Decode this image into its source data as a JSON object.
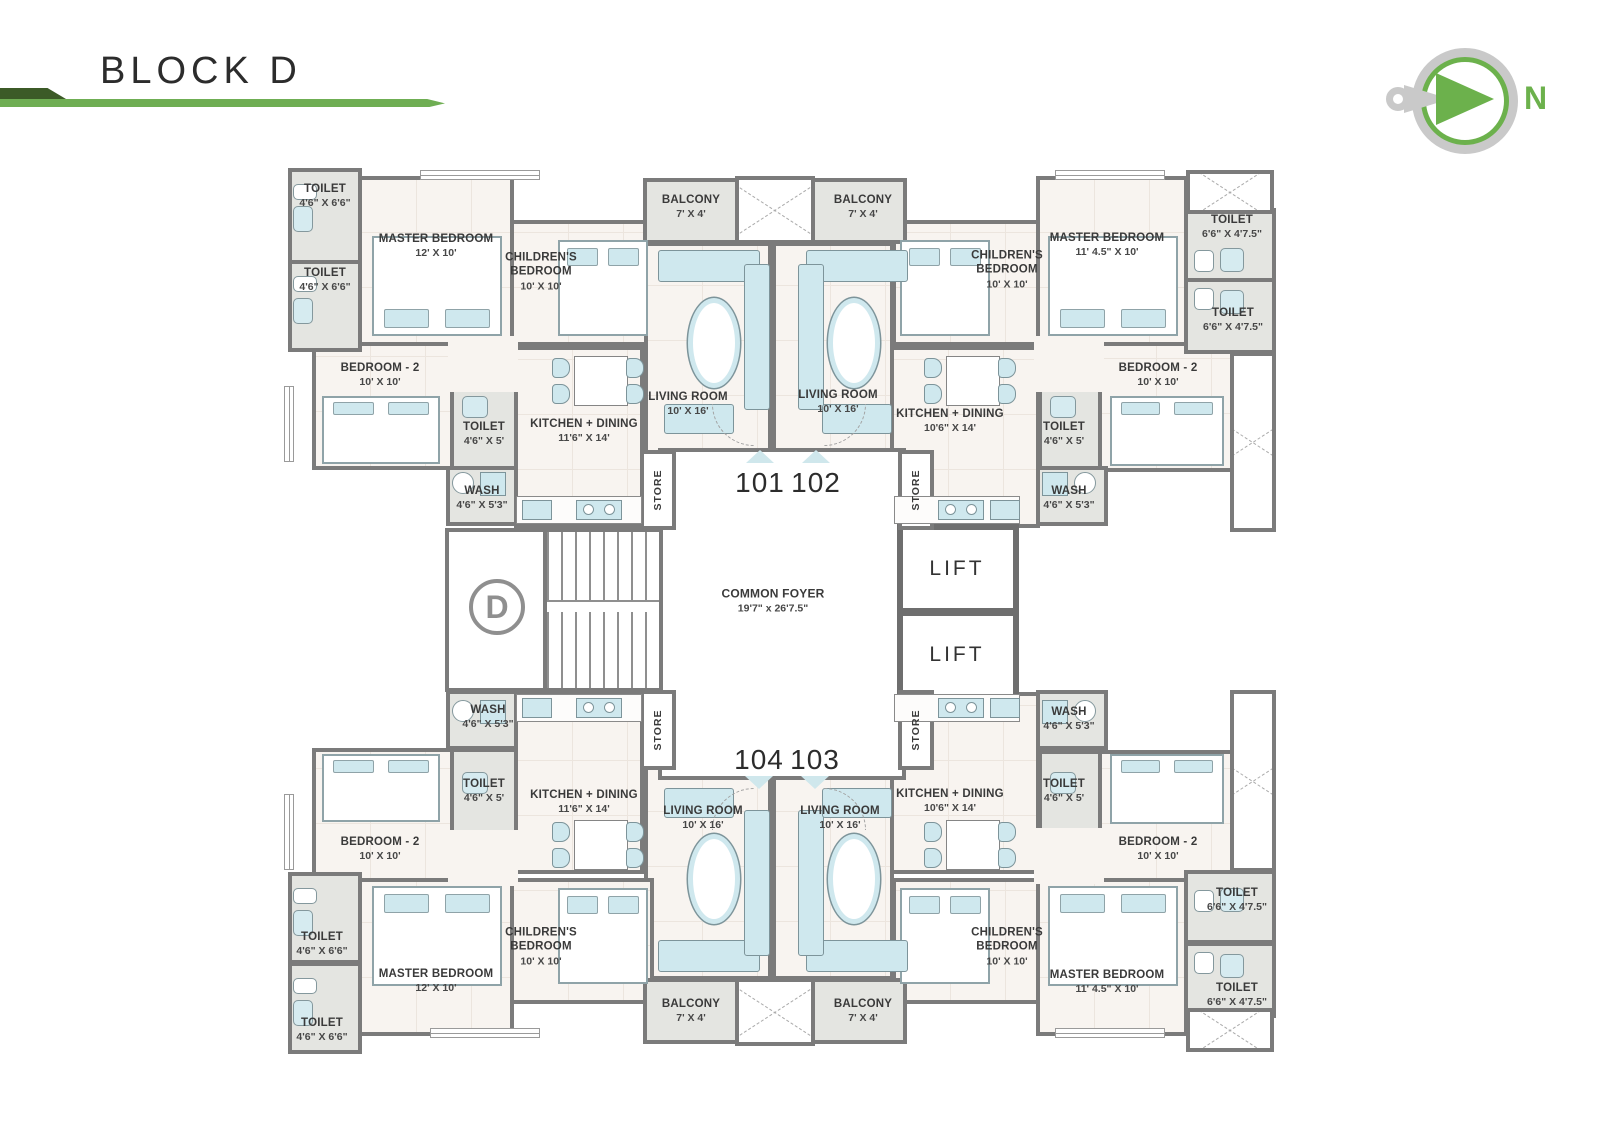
{
  "page": {
    "title": "BLOCK D"
  },
  "compass": {
    "label": "N"
  },
  "colors": {
    "accent_green": "#6cb14c",
    "dark_green": "#3c5a27",
    "wall_gray": "#7b7b7b",
    "service_gray": "#e4e5e1",
    "floor_cream": "#f8f4f0",
    "furniture_blue": "#cfe8ee"
  },
  "core": {
    "foyer_name": "COMMON FOYER",
    "foyer_dims": "19'7\" x 26'7.5\"",
    "lift": "LIFT",
    "store": "STORE",
    "stair_block_letter": "D"
  },
  "entries": {
    "e101": "101",
    "e102": "102",
    "e103": "103",
    "e104": "104"
  },
  "rooms": {
    "master_a": {
      "name": "MASTER BEDROOM",
      "dims": "12' X 10'"
    },
    "master_b": {
      "name": "MASTER BEDROOM",
      "dims": "11' 4.5\" X 10'"
    },
    "children": {
      "name": "CHILDREN'S BEDROOM",
      "dims": "10' X 10'"
    },
    "bedroom2": {
      "name": "BEDROOM - 2",
      "dims": "10' X 10'"
    },
    "toilet_66": {
      "name": "TOILET",
      "dims": "4'6\" X 6'6\""
    },
    "toilet_475": {
      "name": "TOILET",
      "dims": "6'6\" X 4'7.5\""
    },
    "toilet_5": {
      "name": "TOILET",
      "dims": "4'6\" X 5'"
    },
    "wash": {
      "name": "WASH",
      "dims": "4'6\" X 5'3\""
    },
    "kitchen_a": {
      "name": "KITCHEN + DINING",
      "dims": "11'6\" X 14'"
    },
    "kitchen_b": {
      "name": "KITCHEN + DINING",
      "dims": "10'6\" X 14'"
    },
    "living": {
      "name": "LIVING ROOM",
      "dims": "10' X 16'"
    },
    "balcony": {
      "name": "BALCONY",
      "dims": "7' X 4'"
    }
  }
}
